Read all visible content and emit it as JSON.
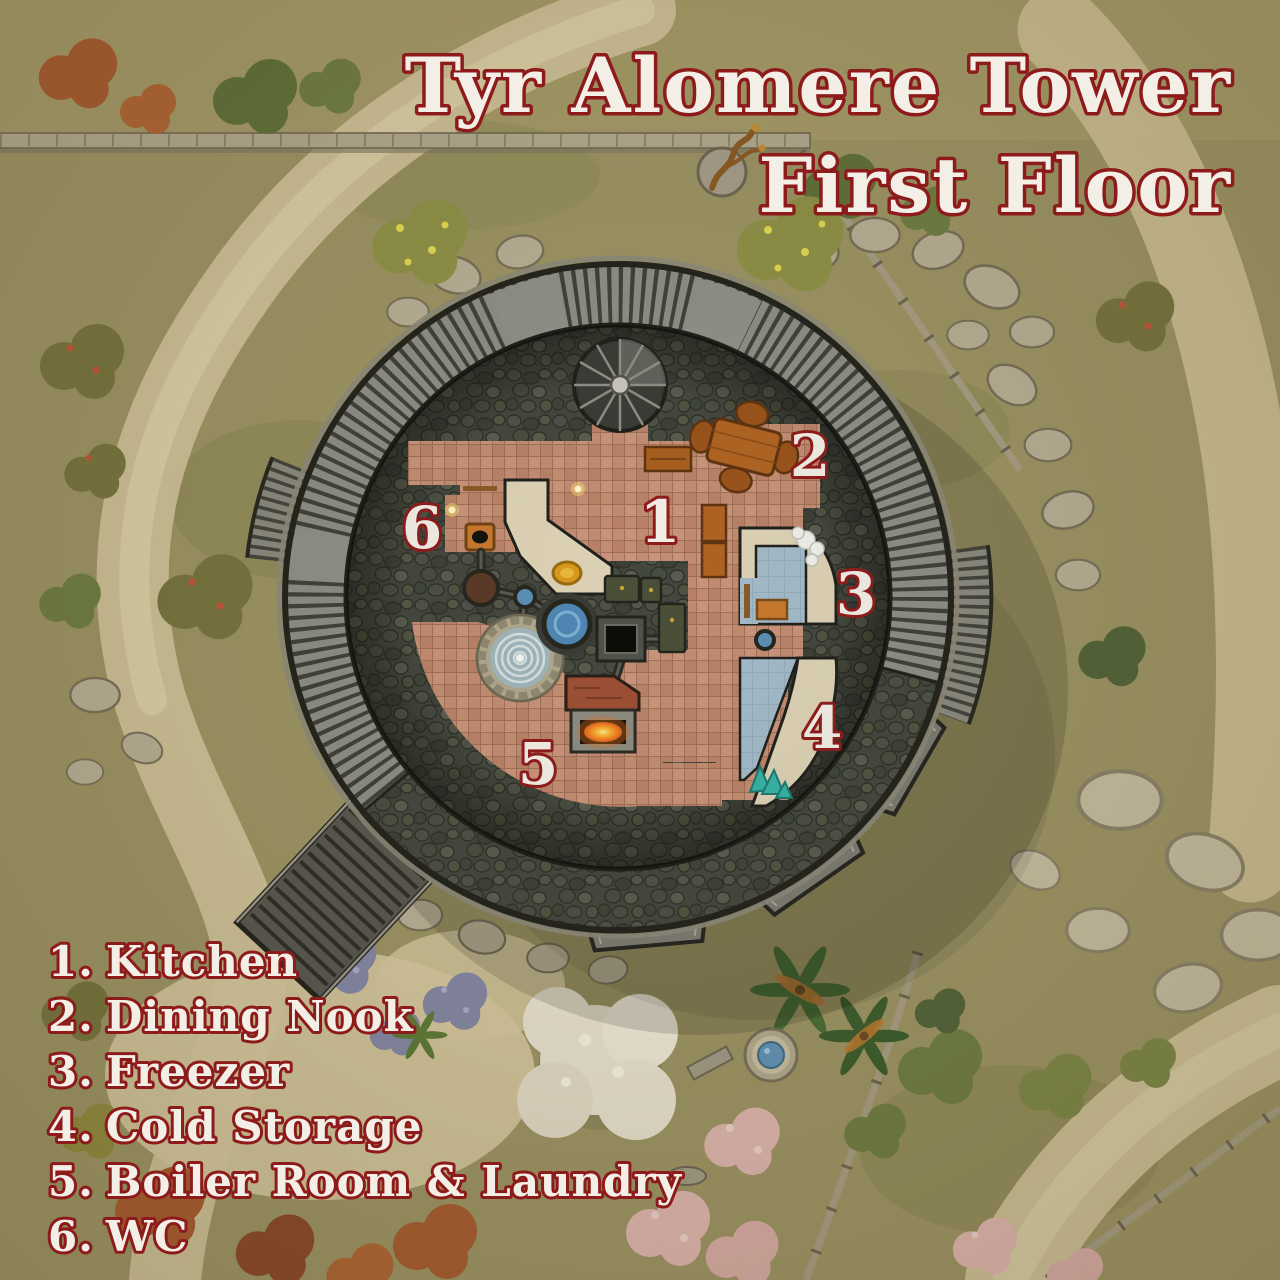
{
  "title": {
    "line1": "Tyr Alomere Tower",
    "line2": "First Floor"
  },
  "legend": {
    "items": [
      {
        "number": "1.",
        "label": "Kitchen"
      },
      {
        "number": "2.",
        "label": "Dining Nook"
      },
      {
        "number": "3.",
        "label": "Freezer"
      },
      {
        "number": "4.",
        "label": "Cold Storage"
      },
      {
        "number": "5.",
        "label": "Boiler Room & Laundry"
      },
      {
        "number": "6.",
        "label": "WC"
      }
    ]
  },
  "rooms": [
    {
      "number": "1",
      "name": "Kitchen"
    },
    {
      "number": "2",
      "name": "Dining Nook"
    },
    {
      "number": "3",
      "name": "Freezer"
    },
    {
      "number": "4",
      "name": "Cold Storage"
    },
    {
      "number": "5",
      "name": "Boiler Room & Laundry"
    },
    {
      "number": "6",
      "name": "WC"
    }
  ],
  "colors": {
    "label_fill": "#f3efe7",
    "label_outline": "#8e1b1b",
    "terrain_grass": "#9c9464",
    "dirt_path": "#d2c49c",
    "tower_wall_ring": "#8d8e86",
    "tower_stone": "#43473e",
    "floor_tile_terracotta": "#c28d72",
    "floor_walkway_cream": "#ddd2b6",
    "floor_ice": "#a2bac9",
    "wood": "#b06322",
    "fire_glow": "#f08c1e",
    "water": "#4f86b4"
  }
}
